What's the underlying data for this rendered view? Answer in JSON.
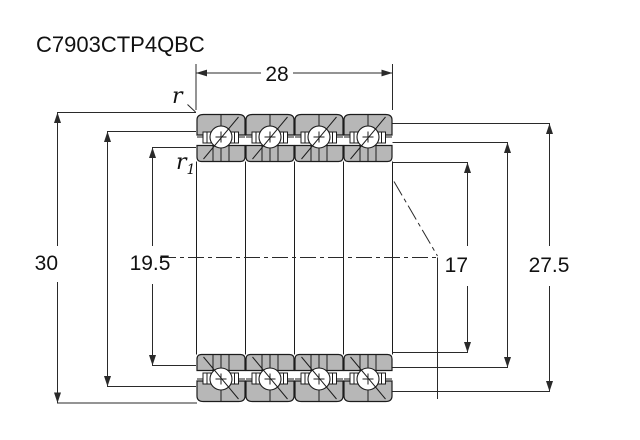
{
  "title": "C7903CTP4QBC",
  "drawing": {
    "dim_total_width": "28",
    "dim_outer_diameter": "30",
    "dim_shaft_abutment": "19.5",
    "dim_bore": "17",
    "dim_housing_abutment": "27.5",
    "chamfer_outer": "r",
    "chamfer_inner_base": "r",
    "chamfer_inner_sub": "1"
  },
  "colors": {
    "ring-fill": "#b7b7b7",
    "outline": "#1c1c1c",
    "dim-line": "#2a2a2a",
    "text": "#111111",
    "background": "#ffffff"
  }
}
